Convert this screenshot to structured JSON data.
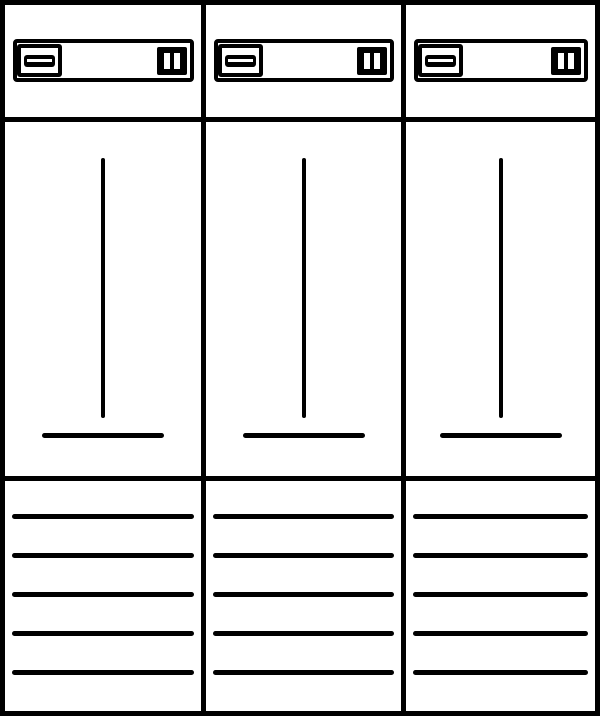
{
  "diagram": {
    "type": "meter-cabinet-front-view",
    "colors": {
      "background": "#ffffff",
      "line": "#000000"
    },
    "columns": [
      {
        "id": "meter-field-1"
      },
      {
        "id": "meter-field-2"
      },
      {
        "id": "meter-field-3"
      }
    ],
    "column_template": {
      "header_panel": {
        "left_symbol": "slotted-mount-block",
        "right_symbol": "twin-slot-block"
      },
      "meter_field": {
        "elements": [
          "vertical-guide-line",
          "base-line"
        ]
      },
      "terminal_field": {
        "line_count": 5,
        "first_line_offset_px": 33,
        "line_spacing_px": 39
      }
    }
  }
}
